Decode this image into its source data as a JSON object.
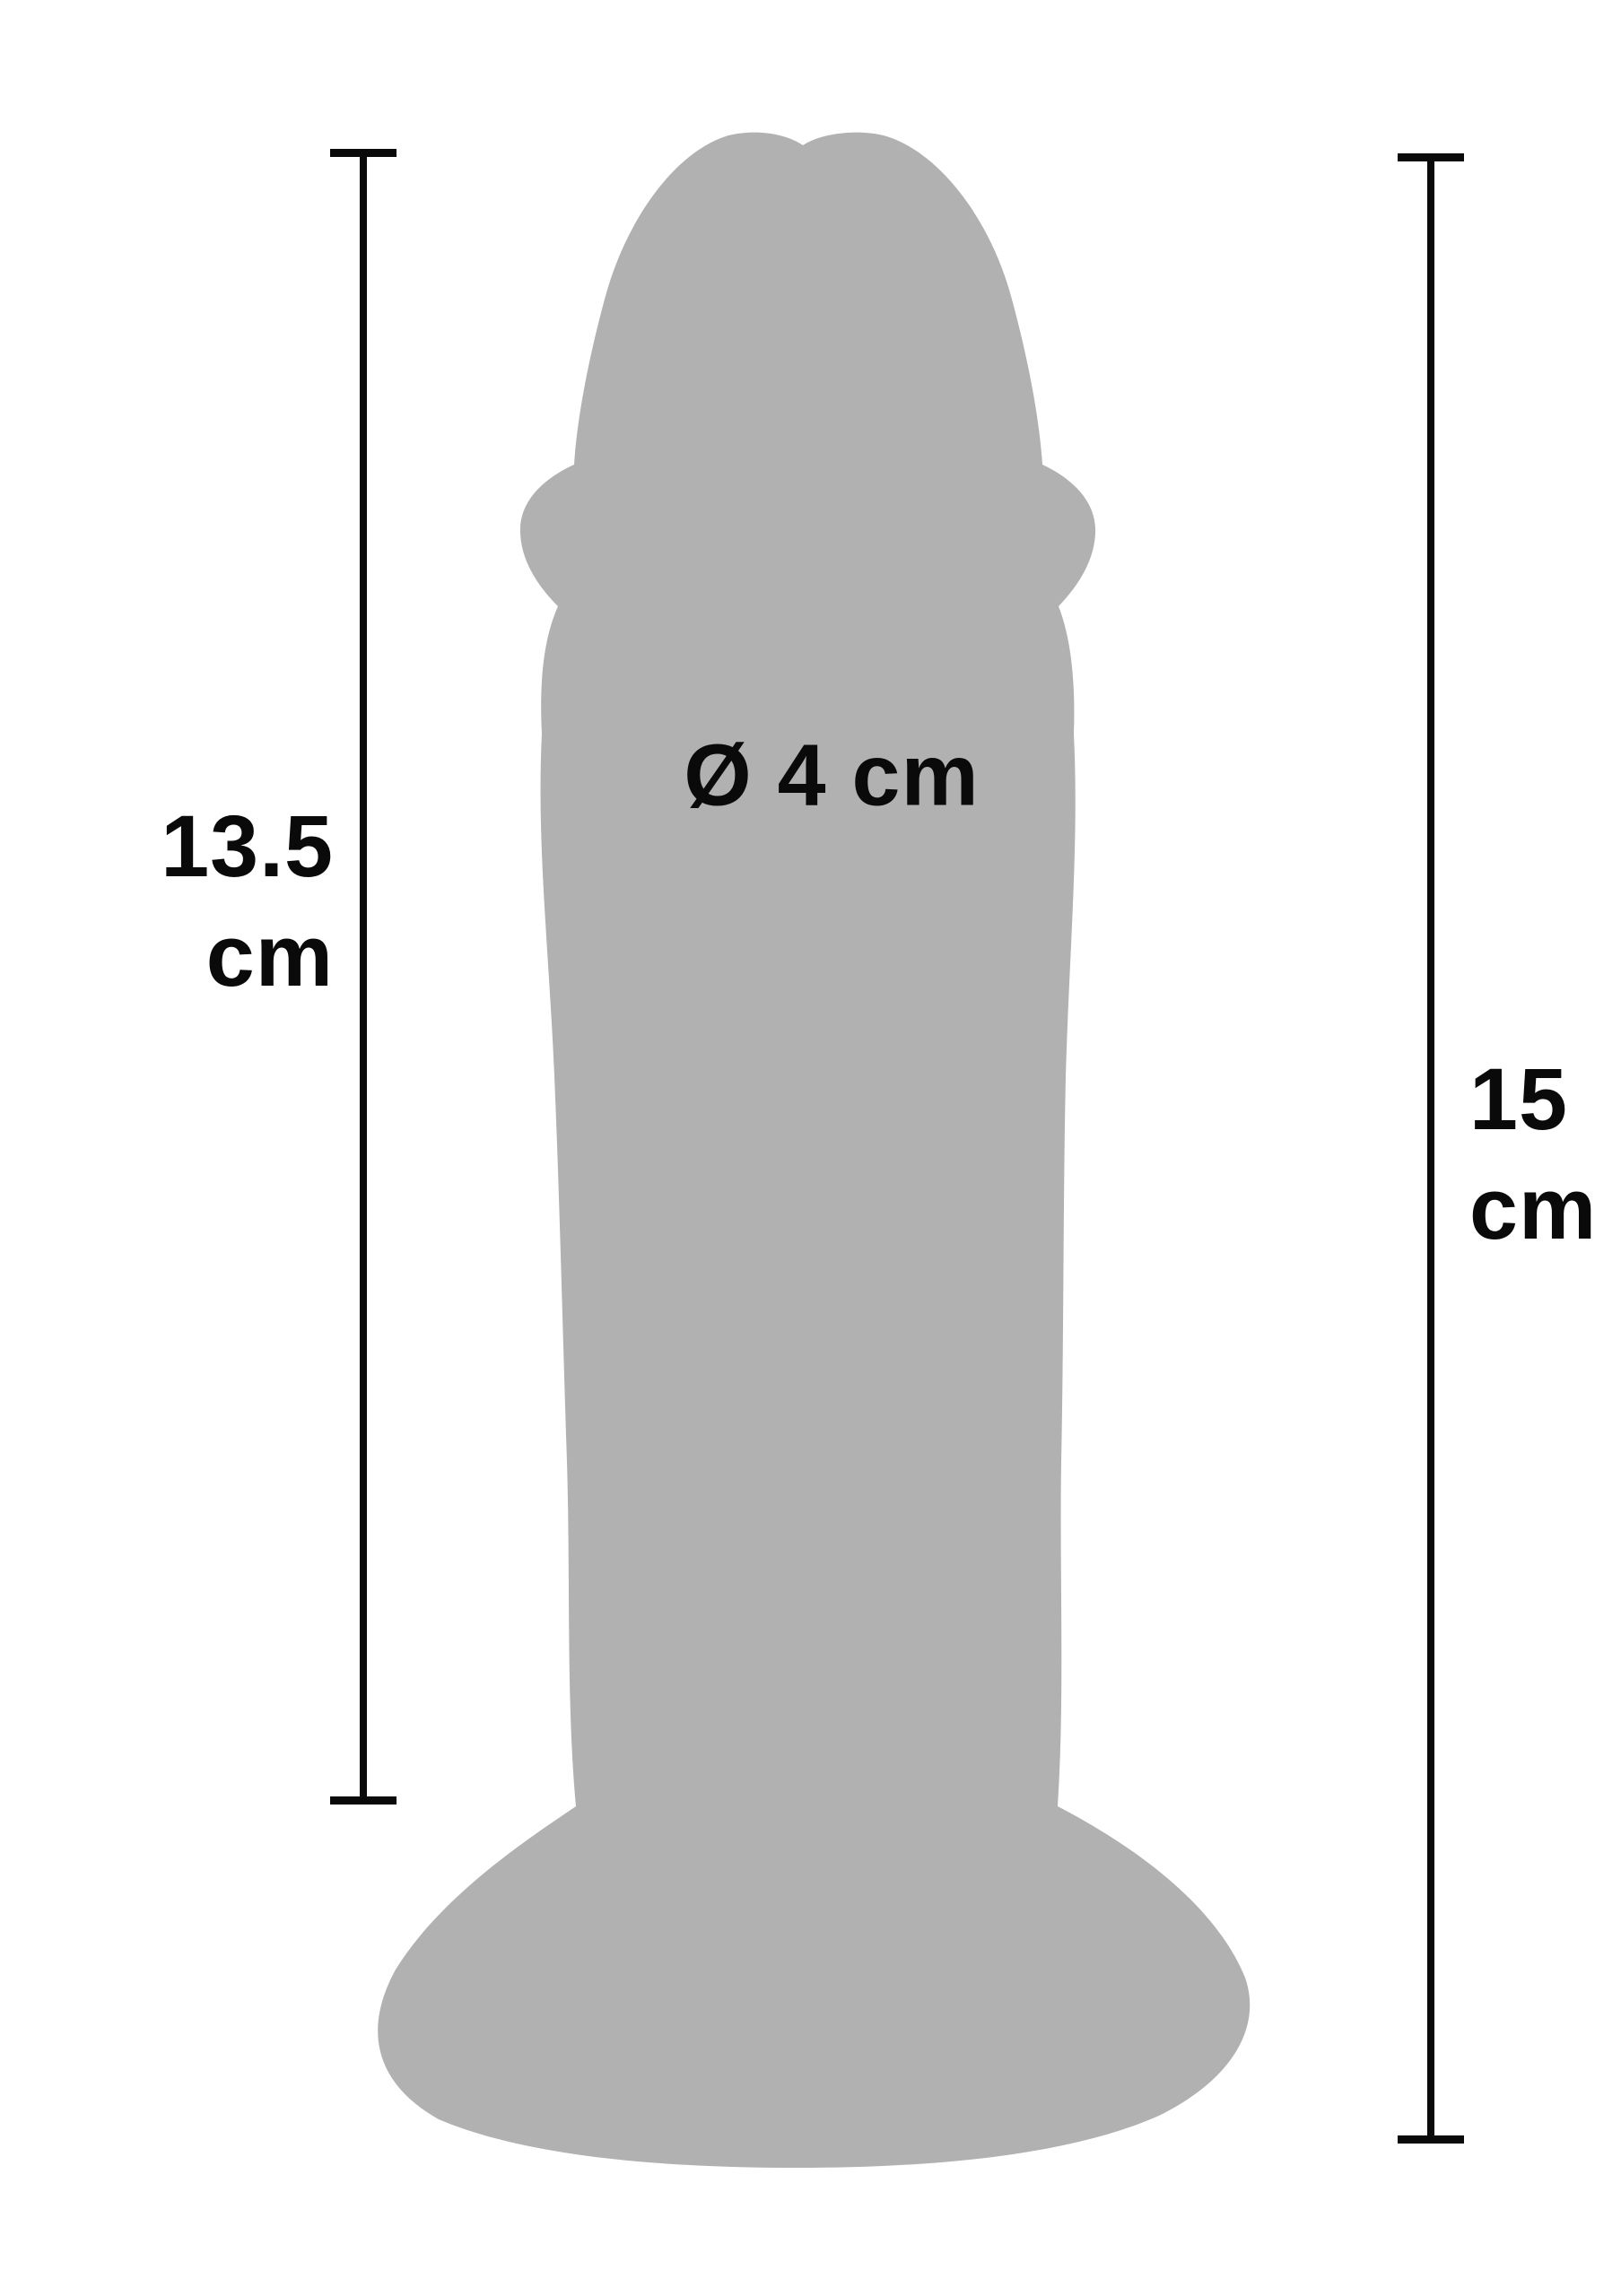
{
  "figure": {
    "type": "product-dimension-diagram",
    "subject": "dildo-with-suction-cup-silhouette",
    "colors": {
      "silhouette_gray": "#b1b1b1",
      "line_black": "#0a0a0a",
      "background": "#ffffff"
    }
  },
  "labels": {
    "left_measurement": {
      "value": "13.5",
      "unit": "cm"
    },
    "right_measurement": {
      "value": "15",
      "unit": "cm"
    },
    "diameter": {
      "label": "Ø 4 cm"
    }
  }
}
